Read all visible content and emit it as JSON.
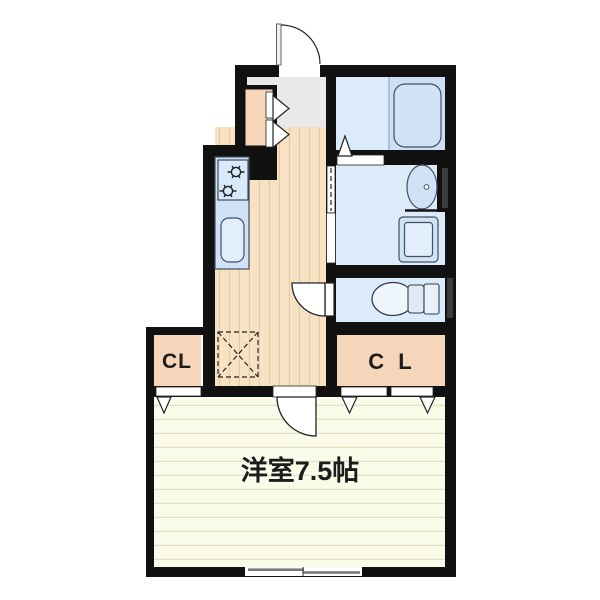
{
  "plan": {
    "title": "apartment-floor-plan",
    "labels": {
      "closet_left": "CL",
      "closet_right": "C L",
      "main_room": "洋室7.5帖"
    },
    "colors": {
      "wall": "#111111",
      "entrance_floor": "#e9e9e9",
      "wood_floor": "#f7e2c4",
      "wood_stripe": "#e4cda6",
      "room_floor": "#fafbe9",
      "room_stripe": "#e3e3c3",
      "closet_floor": "#f6d6ba",
      "wet_floor": "#dcebfa",
      "tub_zone": "#cddff4",
      "fixture_fill": "#cfe2f6",
      "fixture_light": "#e2eefb",
      "window_bar": "#7a7a7a",
      "wall_window": "#3c3c3c",
      "text": "#1c1c1c"
    },
    "fixtures": [
      "entrance-door",
      "shoe-closet",
      "bathtub",
      "folding-bath-door",
      "wash-basin",
      "washing-machine-pan",
      "toilet",
      "gas-stove",
      "kitchen-sink",
      "kitchen-counter",
      "refrigerator-space",
      "sliding-window",
      "closet-doors"
    ]
  }
}
